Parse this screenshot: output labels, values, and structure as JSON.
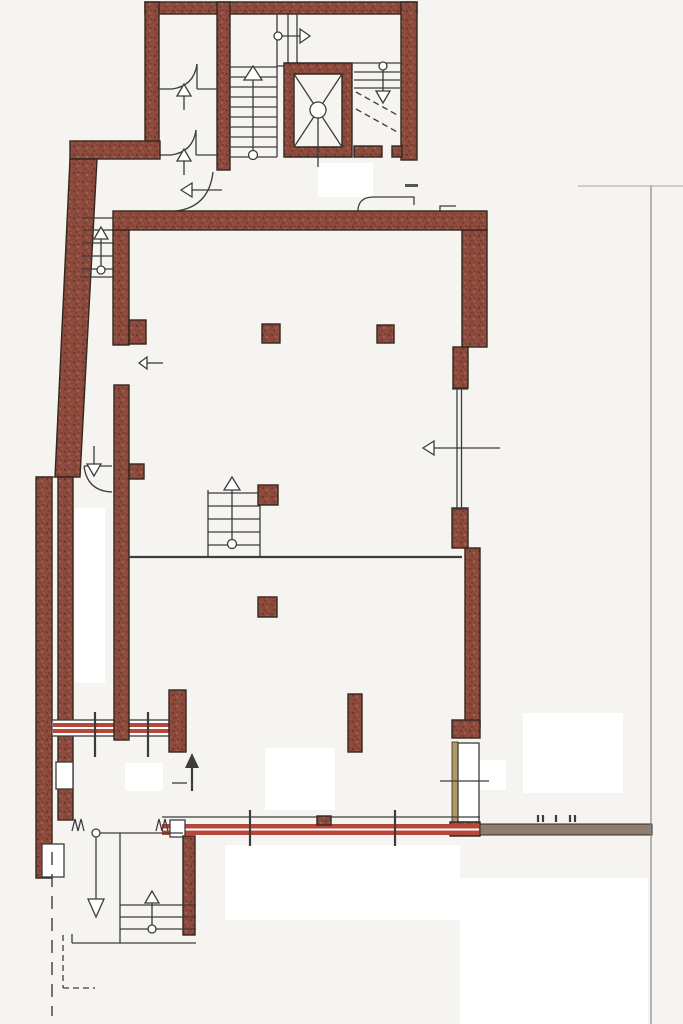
{
  "document": {
    "kind": "scanned architectural floor plan",
    "visible_text": [],
    "orientation": "portrait",
    "page_size_px": {
      "width": 683,
      "height": 1024
    }
  },
  "colors": {
    "bg": "#f6f4f1",
    "wall-fill": "#8c4a3c",
    "wall-dark": "#6e352c",
    "wall-light": "#a2604e",
    "wall-stroke": "#33271f",
    "line": "#3c3c3c",
    "line-faint": "#b9b4ae",
    "glass-red": "#b5483a",
    "band-grey": "#8f7e70",
    "door-strip": "#ad9a64"
  },
  "plan_inventory": {
    "rooms": [
      {
        "id": "stair-core",
        "features": [
          "main-stair",
          "elevator-shaft",
          "secondary-stair",
          "two-small-rooms",
          "landing"
        ]
      },
      {
        "id": "entrance-lobby",
        "features": [
          "door-swing",
          "left-arrow",
          "low-bench-outline"
        ]
      },
      {
        "id": "upper-hall",
        "features": [
          "two-columns",
          "wall-pier",
          "window-right",
          "left-arrow"
        ]
      },
      {
        "id": "lower-hall",
        "features": [
          "column",
          "tall-pillar",
          "side-door",
          "storefront-glazing"
        ]
      },
      {
        "id": "west-corridor",
        "features": [
          "corridor-stair",
          "door-swing",
          "window-band",
          "wall-niches"
        ]
      },
      {
        "id": "exterior-porch",
        "features": [
          "porch-stair",
          "down-arrow",
          "dashed-site-lines"
        ]
      }
    ],
    "stairs": [
      {
        "id": "core-main-stair",
        "treads": 10,
        "arrow": "up",
        "start_circle": true
      },
      {
        "id": "core-secondary-stair",
        "treads": 3,
        "arrow": "down",
        "dashed_diagonals": true
      },
      {
        "id": "west-corridor-stair",
        "treads": 4,
        "arrow": "up",
        "start_circle": true
      },
      {
        "id": "hall-center-stair",
        "treads": 5,
        "arrow": "up",
        "start_circle": true
      },
      {
        "id": "porch-stair",
        "treads": 3,
        "arrow": "up",
        "start_circle": true
      }
    ],
    "elevator": {
      "x_cross": true,
      "center_circle": true,
      "leader_line": true
    },
    "arrows": {
      "up": 6,
      "down": 3,
      "left": 3,
      "right": 1
    },
    "door_swings": 6,
    "columns": 6,
    "glazing_bands": [
      {
        "id": "storefront",
        "fill": "glass-red",
        "mullions": 2
      },
      {
        "id": "corridor-window-band",
        "fill": "glass-red",
        "mullions": 2
      },
      {
        "id": "right-window",
        "orientation": "vertical"
      }
    ],
    "site_lines": {
      "property_line_right": true,
      "dashed_lines_bottom_left": 3
    }
  }
}
